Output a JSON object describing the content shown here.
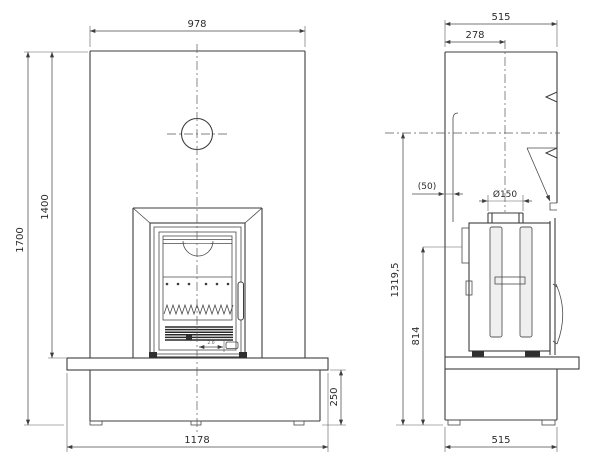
{
  "drawing": {
    "description": "fireplace-technical-drawing",
    "colors": {
      "line": "#3d3d3d",
      "dimension_text": "#2b2b2b",
      "background": "#ffffff"
    },
    "front_view": {
      "dimensions": {
        "overall_width": "978",
        "opening_height": "1400",
        "overall_height": "1700",
        "bench_height": "250",
        "bench_width": "1178",
        "door_detail": "2.0"
      }
    },
    "side_view": {
      "dimensions": {
        "depth_top": "515",
        "flue_center_offset": "278",
        "rear_gap": "(50)",
        "flue_diameter": "Ø150",
        "flue_center_height": "1319,5",
        "stove_top_height": "814",
        "depth_bottom": "515"
      }
    }
  }
}
